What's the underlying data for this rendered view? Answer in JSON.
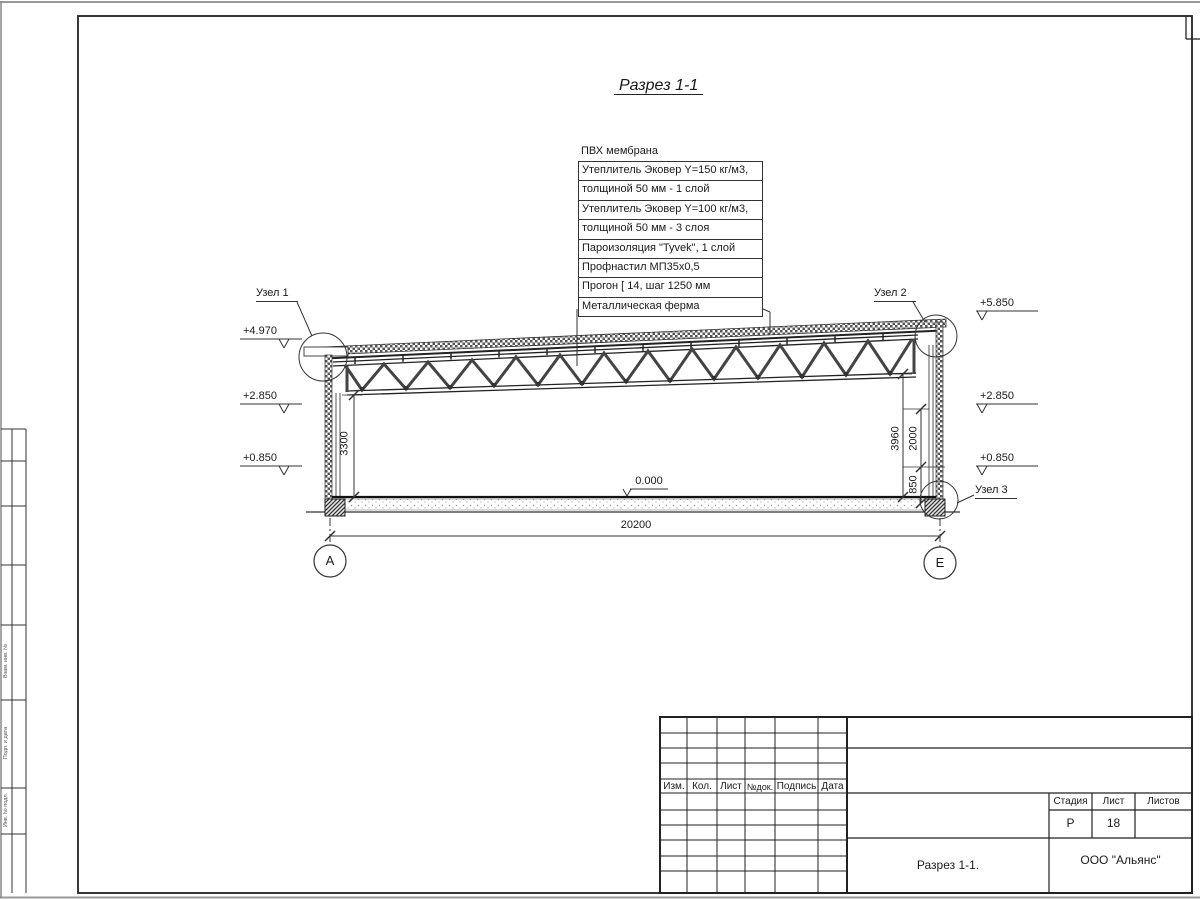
{
  "title": "Разрез 1-1",
  "callout": {
    "rows": [
      "ПВХ мембрана",
      "Утеплитель Эковер Y=150 кг/м3,",
      "толщиной 50 мм - 1 слой",
      "Утеплитель Эковер Y=100 кг/м3,",
      "толщиной 50 мм - 3 слоя",
      "Пароизоляция \"Tyvek\", 1 слой",
      "Профнастил МП35х0,5",
      "Прогон [ 14, шаг 1250 мм",
      "Металлическая ферма"
    ]
  },
  "nodes": {
    "node1": "Узел 1",
    "node2": "Узел 2",
    "node3": "Узел 3"
  },
  "elevations": {
    "left": [
      "+4.970",
      "+2.850",
      "+0.850"
    ],
    "right": [
      "+5.850",
      "+2.850",
      "+0.850"
    ],
    "zero": "0.000"
  },
  "dimensions": {
    "overall": "20200",
    "left_height": "3300",
    "right_total": "3960",
    "right_upper": "2000",
    "right_lower": "850"
  },
  "axes": {
    "left": "А",
    "right": "Е"
  },
  "titleblock": {
    "rev_headers": [
      "Изм.",
      "Кол.",
      "Лист",
      "№док.",
      "Подпись",
      "Дата"
    ],
    "stage_label": "Стадия",
    "sheet_label": "Лист",
    "sheets_label": "Листов",
    "stage_value": "Р",
    "sheet_value": "18",
    "sheets_value": "",
    "drawing_name": "Разрез 1-1.",
    "company": "ООО \"Альянс\""
  },
  "side_strip": {
    "labels": [
      "Взам. инв. №",
      "Подп. и дата",
      "Инв. № подл."
    ]
  },
  "colors": {
    "line": "#333333",
    "hatch": "#666666"
  }
}
